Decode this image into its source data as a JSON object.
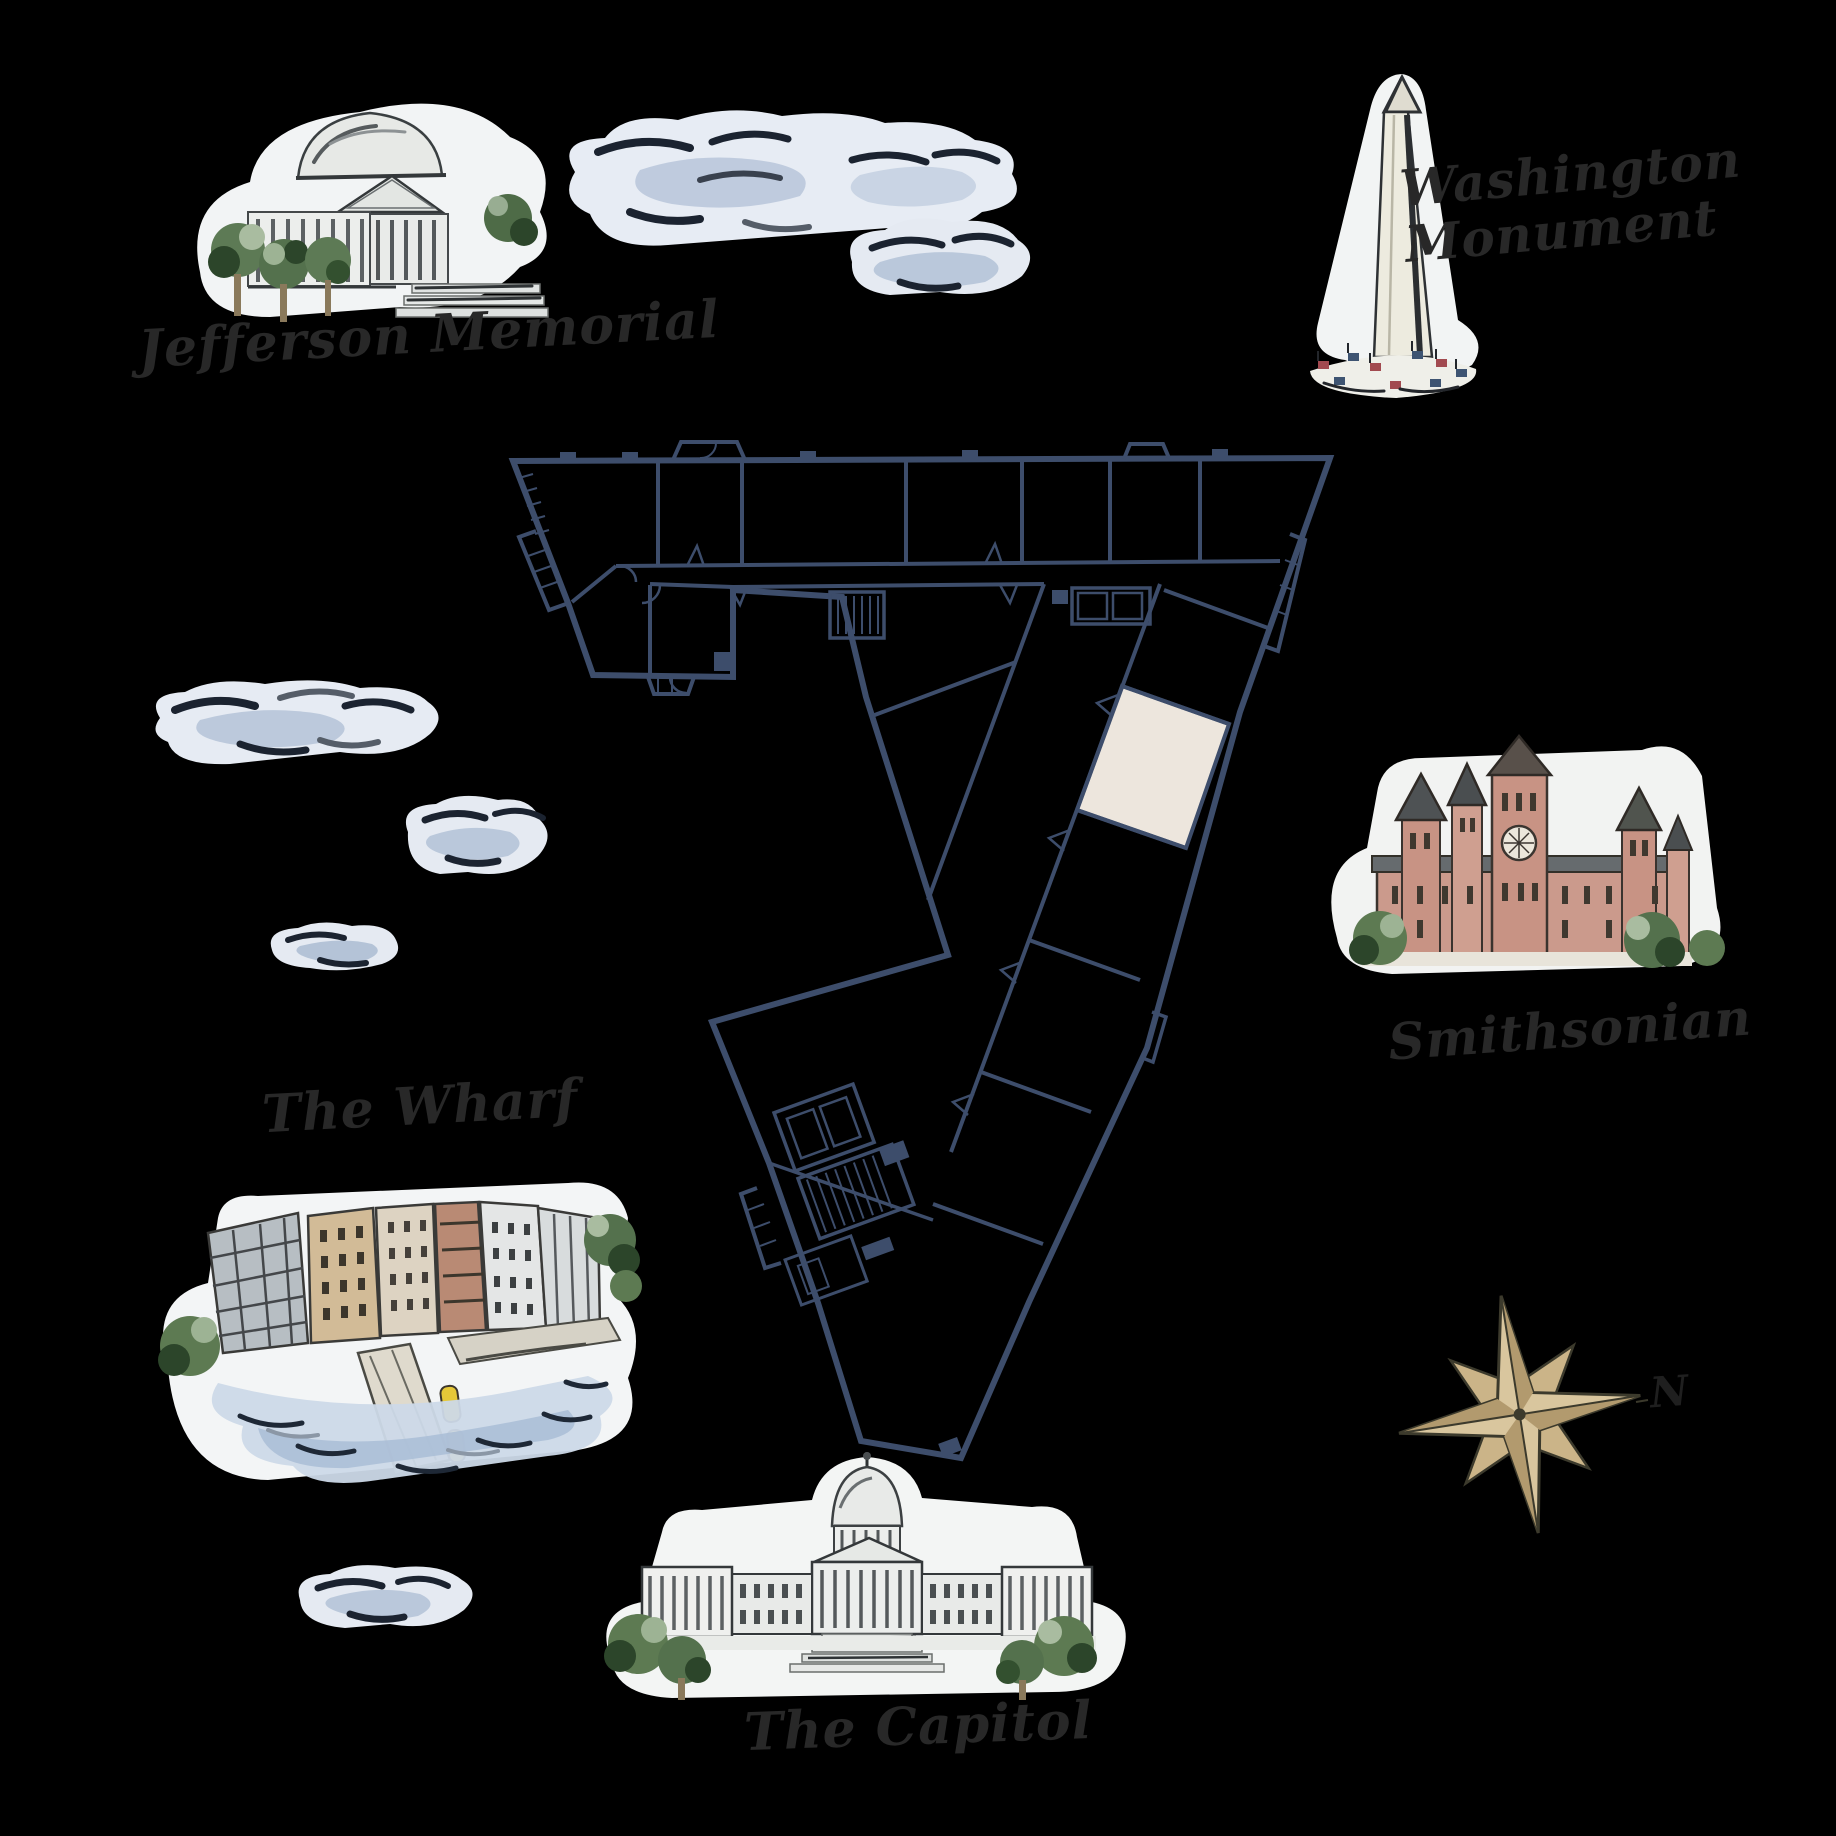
{
  "map": {
    "landmarks": [
      {
        "id": "jefferson-memorial",
        "label": "Jefferson Memorial"
      },
      {
        "id": "washington-monument",
        "label": "Washington Monument"
      },
      {
        "id": "smithsonian",
        "label": "Smithsonian"
      },
      {
        "id": "the-wharf",
        "label": "The Wharf"
      },
      {
        "id": "the-capitol",
        "label": "The Capitol"
      }
    ],
    "compass": {
      "north_label": "N"
    },
    "floor_plan": {
      "wall_color": "#3d4d6b",
      "highlight_color": "#ede6dd",
      "background": "#000000"
    },
    "clouds_count": 6
  }
}
